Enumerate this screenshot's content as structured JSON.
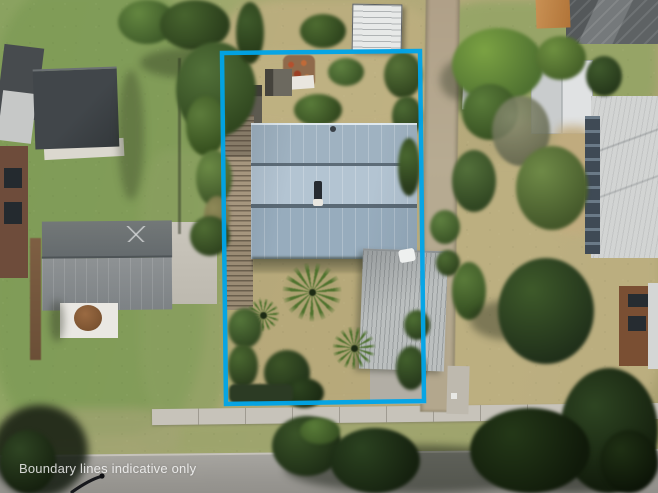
{
  "overlay": {
    "disclaimer": "Boundary lines indicative only",
    "boundary_color": "#00a4e8",
    "boundary_points": "222,53 420,51 424,401 226,404",
    "text_color": "rgba(255,255,255,0.8)"
  },
  "palette": {
    "main_house_roof": "#9fb2c1",
    "main_house_roof_light": "#b3c4d2",
    "garage_roof": "#bbbfbf",
    "left_neighbor_roof": "#7d8285",
    "left_shed_roof": "#3b4043",
    "right_neighbor_roof": "#d2d4d3",
    "dry_grass": "#b8a97b",
    "green_grass": "#7e9b56",
    "road": "#9a9894",
    "footpath": "#c7c3ba",
    "side_lane": "#b3a78d",
    "deck_timber": "#9a8a73",
    "tree_canopy": "#3c5829"
  },
  "scene": {
    "description": "Aerial drone photograph of a residential property outlined with a bright blue boundary overlay: blue-grey roofed house with timber deck, rear garage crossing the side lane, palm trees and dry lawns; neighbouring houses left and right, footpath and street along the bottom with tree canopies."
  }
}
